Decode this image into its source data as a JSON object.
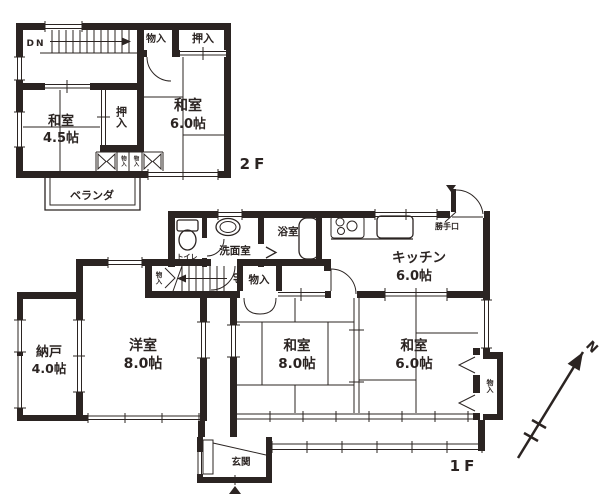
{
  "floor2": {
    "floor_label": "2F",
    "stairs_label": "DN",
    "storage_top": "物入",
    "closet_top": "押入",
    "washitsu6": {
      "name": "和室",
      "size": "6.0帖"
    },
    "closet_mid": "押入",
    "washitsu45": {
      "name": "和室",
      "size": "4.5帖"
    },
    "storage_small_left": "物入",
    "storage_small_right": "物入",
    "veranda": "ベランダ"
  },
  "floor1": {
    "floor_label": "1F",
    "stairs_label": "UP",
    "toilet": "トイレ",
    "washroom": "洗面室",
    "bathroom": "浴室",
    "kitchen": {
      "name": "キッチン",
      "size": "6.0帖"
    },
    "back_door": "勝手口",
    "storage_stairs": "物入",
    "storage_hall": "物入",
    "storage_east": "物入",
    "nando": {
      "name": "納戸",
      "size": "4.0帖"
    },
    "youshitsu": {
      "name": "洋室",
      "size": "8.0帖"
    },
    "washitsu8": {
      "name": "和室",
      "size": "8.0帖"
    },
    "washitsu6": {
      "name": "和室",
      "size": "6.0帖"
    },
    "genkan": "玄関"
  },
  "compass": {
    "north_label": "N"
  },
  "colors": {
    "line": "#2b2422",
    "background": "#ffffff"
  }
}
